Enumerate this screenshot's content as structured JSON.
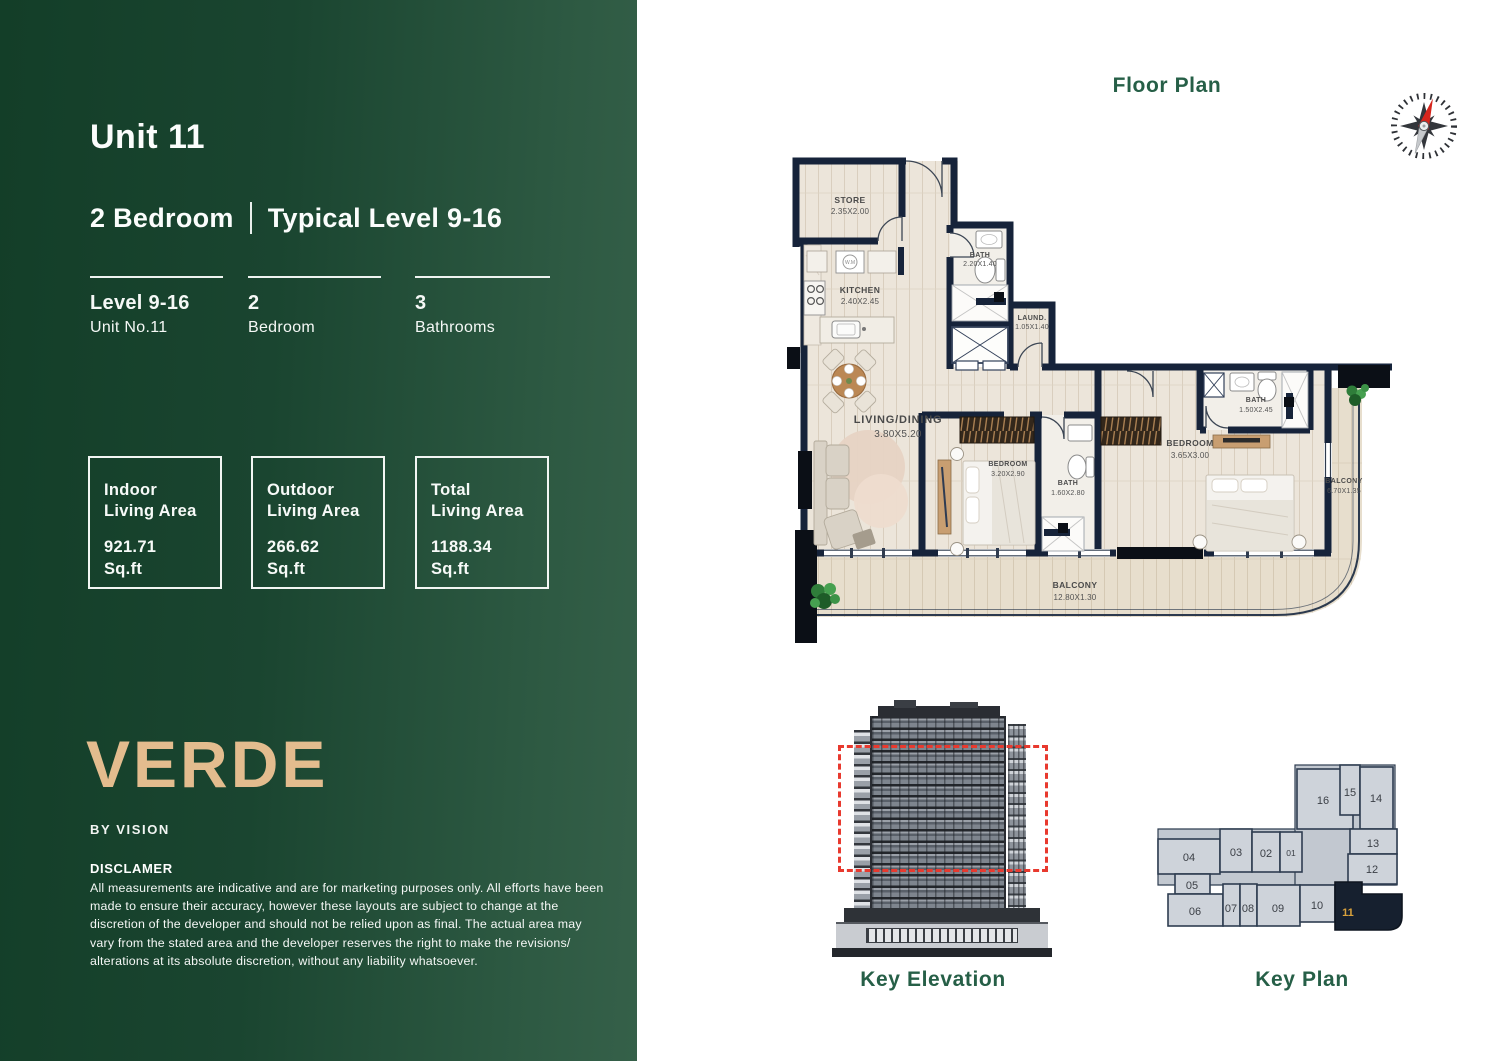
{
  "sidebar": {
    "unit_title": "Unit 11",
    "subtitle": {
      "left": "2 Bedroom",
      "right": "Typical Level 9-16"
    },
    "stats": [
      {
        "top": "Level 9-16",
        "bottom": "Unit No.11"
      },
      {
        "top": "2",
        "bottom": "Bedroom"
      },
      {
        "top": "3",
        "bottom": "Bathrooms"
      }
    ],
    "area_boxes": [
      {
        "l1": "Indoor",
        "l2": "Living Area",
        "value": "921.71",
        "unit": "Sq.ft"
      },
      {
        "l1": "Outdoor",
        "l2": "Living Area",
        "value": "266.62",
        "unit": "Sq.ft"
      },
      {
        "l1": "Total",
        "l2": "Living Area",
        "value": "1188.34",
        "unit": "Sq.ft"
      }
    ],
    "brand": {
      "logo": "VERDE",
      "tagline": "BY VISION"
    },
    "disclaimer": {
      "title": "DISCLAMER",
      "body": "All measurements are indicative and are for marketing purposes only. All efforts have been made to ensure their accuracy, however these layouts are subject to change at the discretion of the developer and should not be relied upon as final. The actual area may vary from the stated area and the developer reserves the right to make the revisions/ alterations at its absolute discretion, without any liability whatsoever."
    }
  },
  "floor_plan": {
    "title": "Floor Plan",
    "appliance_label": "W.M",
    "rooms": [
      {
        "name": "STORE",
        "dims": "2.35X2.00"
      },
      {
        "name": "KITCHEN",
        "dims": "2.40X2.45"
      },
      {
        "name": "BATH",
        "dims": "2.20X1.40"
      },
      {
        "name": "LAUND.",
        "dims": "1.05X1.40"
      },
      {
        "name": "LIVING/DINING",
        "dims": "3.80X5.20"
      },
      {
        "name": "BEDROOM",
        "dims": "3.20X2.90"
      },
      {
        "name": "BATH",
        "dims": "1.60X2.80"
      },
      {
        "name": "BEDROOM",
        "dims": "3.65X3.00"
      },
      {
        "name": "BATH",
        "dims": "1.50X2.45"
      },
      {
        "name": "BALCONY",
        "dims": "6.70X1.35"
      },
      {
        "name": "BALCONY",
        "dims": "12.80X1.30"
      }
    ]
  },
  "key_elevation": {
    "label": "Key Elevation"
  },
  "key_plan": {
    "label": "Key Plan",
    "highlighted_unit": "11",
    "units": [
      "01",
      "02",
      "03",
      "04",
      "05",
      "06",
      "07",
      "08",
      "09",
      "10",
      "11",
      "12",
      "13",
      "14",
      "15",
      "16"
    ]
  },
  "colors": {
    "sidebar_green_dark": "#133e28",
    "sidebar_green_light": "#356049",
    "brand_gold": "#e3bc8e",
    "heading_green": "#265f47",
    "wall_navy": "#16233a",
    "highlight_unit_gold": "#d9a13c",
    "elevation_highlight_red": "#e8392e"
  }
}
